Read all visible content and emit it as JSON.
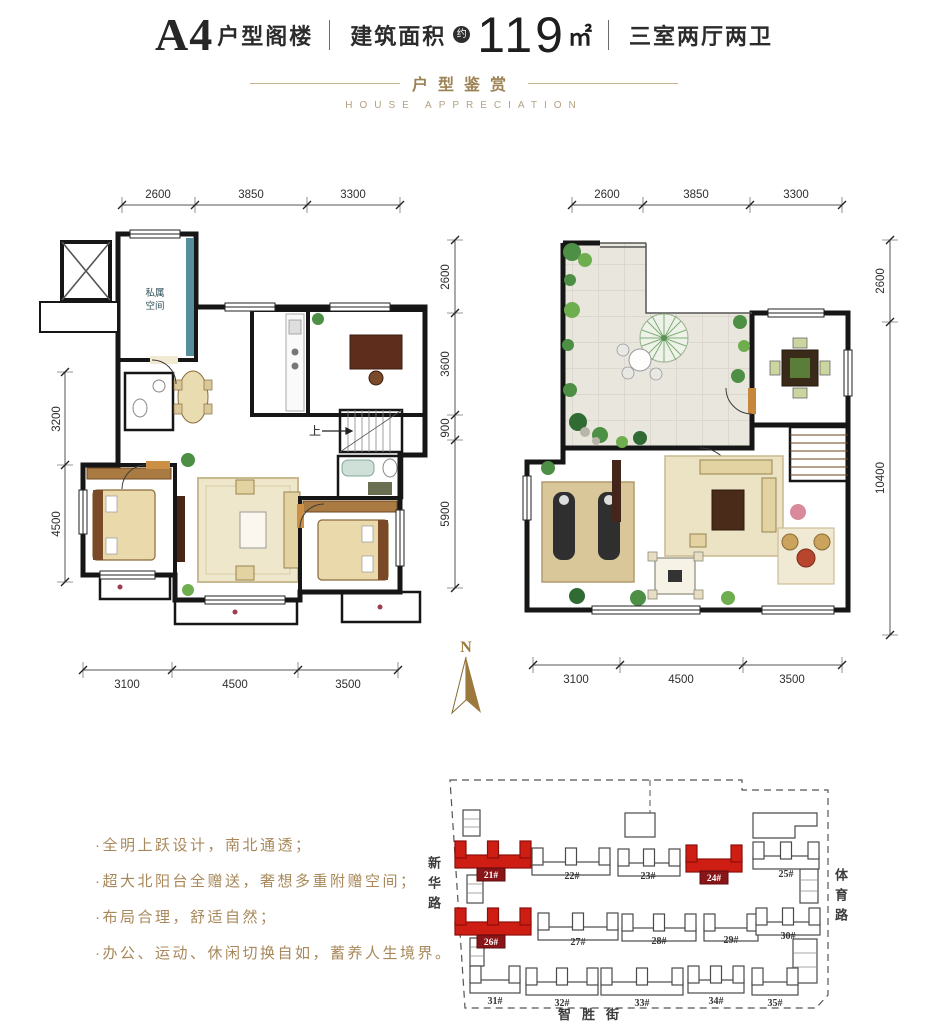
{
  "title": {
    "model": "A4",
    "model_suffix": "户型阁楼",
    "separator": "|",
    "area_label": "建筑面积",
    "area_approx": "约",
    "area_value": "119",
    "area_unit": "㎡",
    "layout": "三室两厅两卫"
  },
  "subtitle": {
    "cn": "户型鉴赏",
    "en": "HOUSE APPRECIATION"
  },
  "compass_label": "N",
  "plans": {
    "lower": {
      "dims_top": [
        "2600",
        "3850",
        "3300"
      ],
      "dims_bottom": [
        "3100",
        "4500",
        "3500"
      ],
      "dims_left": [
        "3200",
        "4500"
      ],
      "dims_right": [
        "2600",
        "3600",
        "900",
        "5900"
      ],
      "room_private": [
        "私属",
        "空间"
      ],
      "stairs_up": "上"
    },
    "upper": {
      "dims_top": [
        "2600",
        "3850",
        "3300"
      ],
      "dims_bottom": [
        "3100",
        "4500",
        "3500"
      ],
      "dims_right": [
        "2600",
        "10400"
      ]
    }
  },
  "features": [
    "·全明上跃设计，南北通透；",
    "·超大北阳台全赠送，奢想多重附赠空间；",
    "·布局合理，舒适自然；",
    "·办公、运动、休闲切换自如，蓄养人生境界。"
  ],
  "site_map": {
    "roads": {
      "west": "新华路",
      "east": "体育路",
      "south": "智胜街"
    },
    "buildings": [
      {
        "id": "21#",
        "highlight": true
      },
      {
        "id": "22#",
        "highlight": false
      },
      {
        "id": "23#",
        "highlight": false
      },
      {
        "id": "24#",
        "highlight": true
      },
      {
        "id": "25#",
        "highlight": false
      },
      {
        "id": "26#",
        "highlight": true
      },
      {
        "id": "27#",
        "highlight": false
      },
      {
        "id": "28#",
        "highlight": false
      },
      {
        "id": "29#",
        "highlight": false
      },
      {
        "id": "30#",
        "highlight": false
      },
      {
        "id": "31#",
        "highlight": false
      },
      {
        "id": "32#",
        "highlight": false
      },
      {
        "id": "33#",
        "highlight": false
      },
      {
        "id": "34#",
        "highlight": false
      },
      {
        "id": "35#",
        "highlight": false
      }
    ]
  },
  "colors": {
    "accent_red": "#ce1d12",
    "badge_red": "#8a1519",
    "gold_text": "#a8885a",
    "teal_room": "#66a3b0",
    "wood_floor": "#c6873c",
    "balcony_pink": "#c2576b"
  }
}
